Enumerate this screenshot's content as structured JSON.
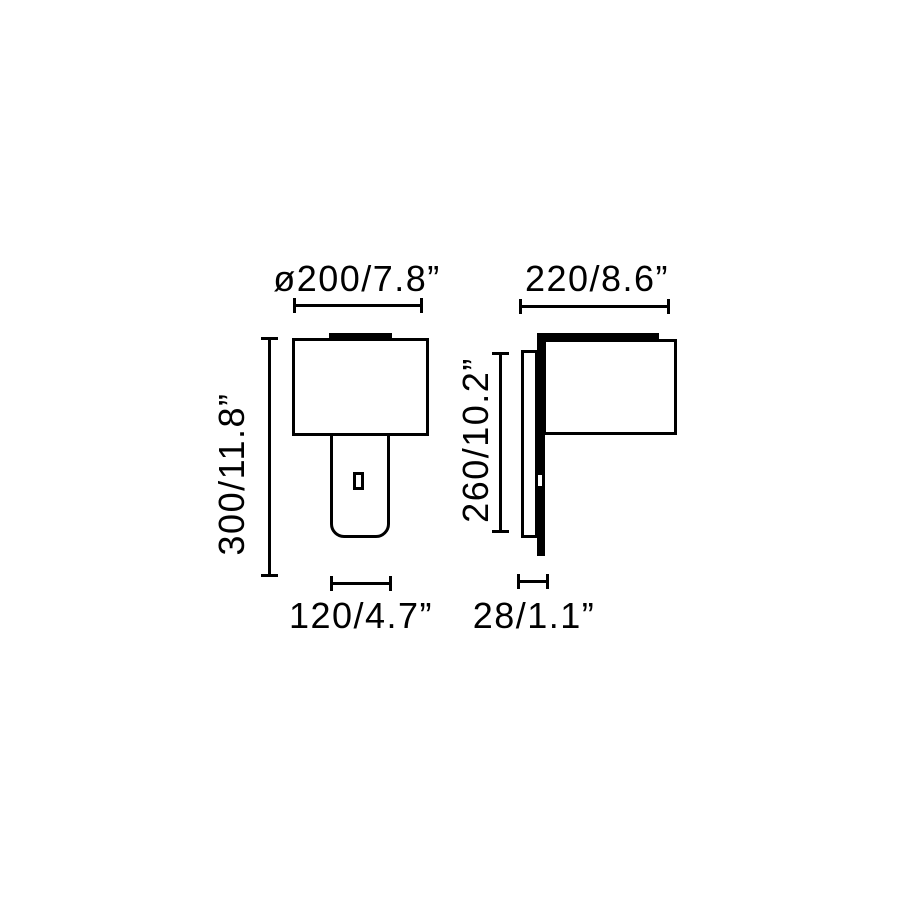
{
  "page": {
    "background": "#ffffff",
    "line_color": "#000000",
    "text_color": "#000000"
  },
  "views": {
    "front": {
      "width_label": "ø200/7.8”",
      "height_label": "300/11.8”",
      "base_width_label": "120/4.7”"
    },
    "side": {
      "width_label": "220/8.6”",
      "height_label": "260/10.2”",
      "depth_label": "28/1.1”"
    }
  }
}
